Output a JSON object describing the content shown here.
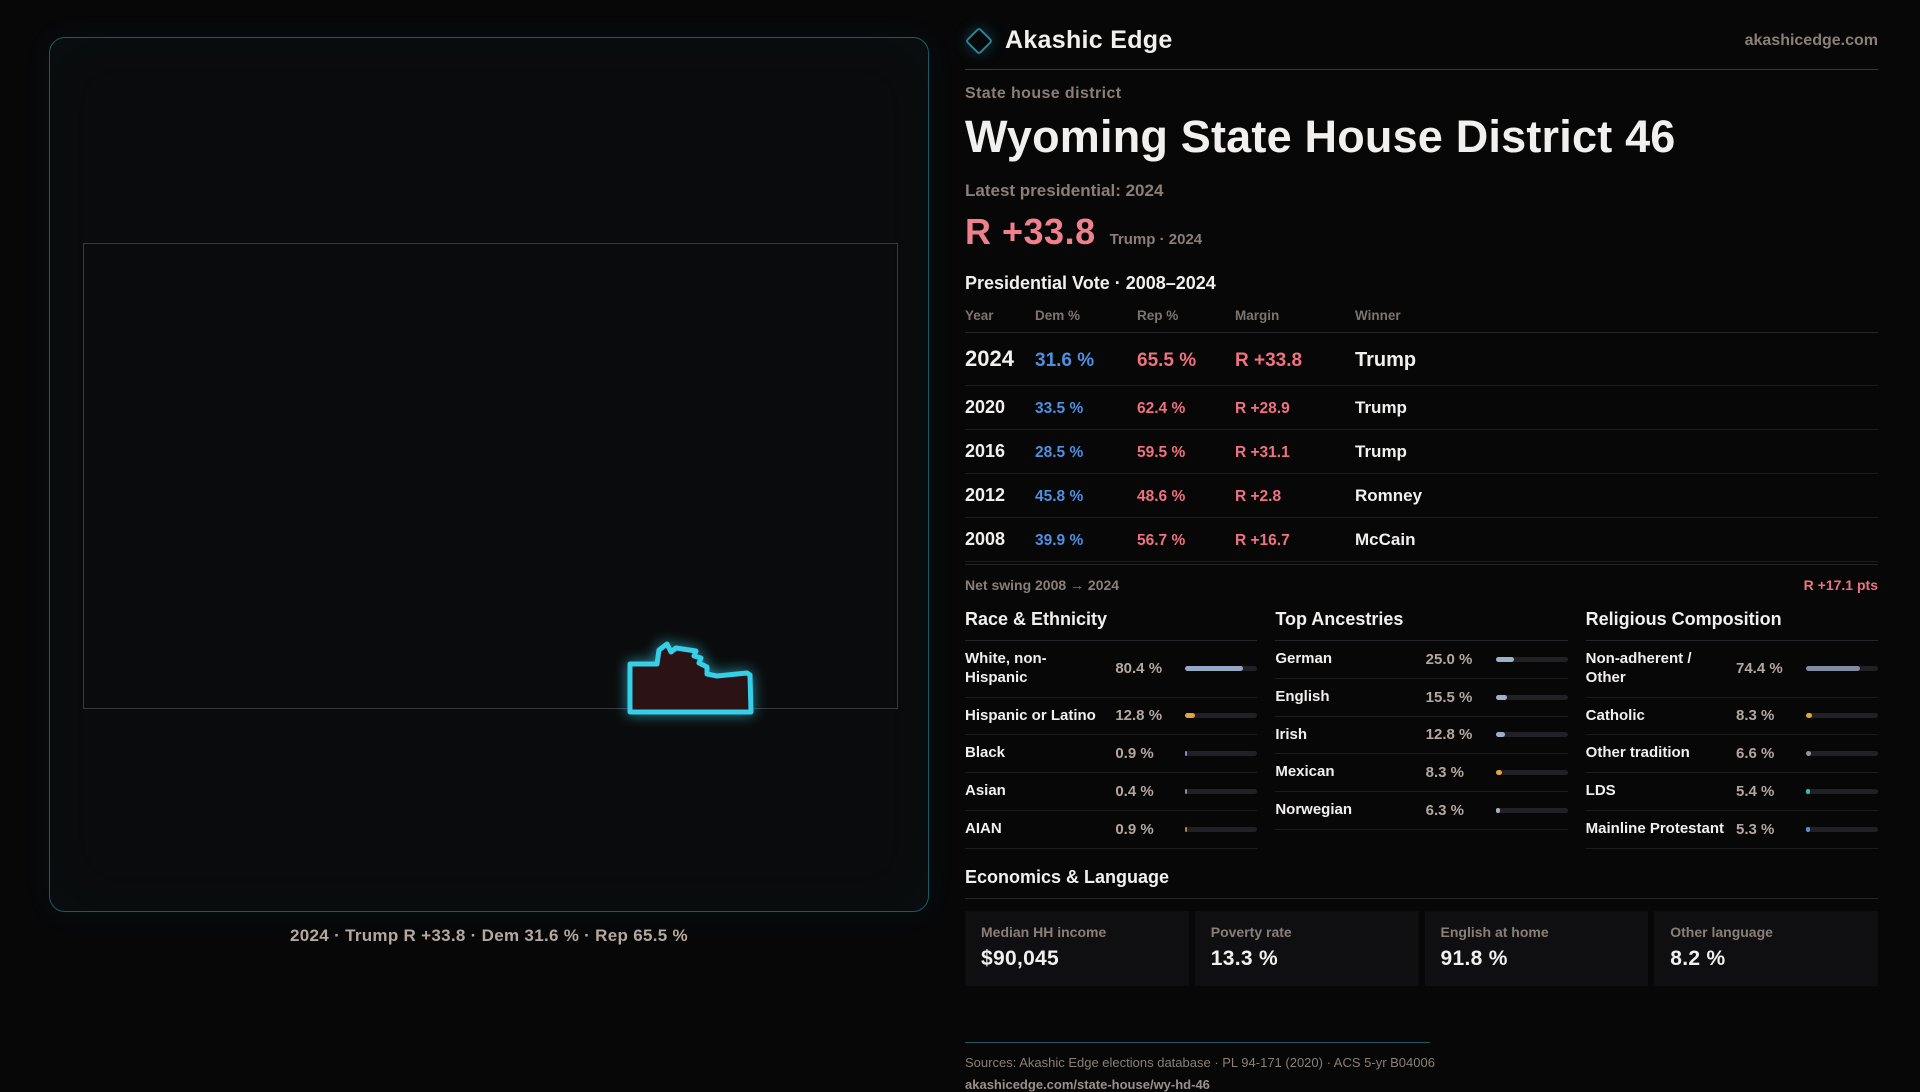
{
  "brand": {
    "name": "Akashic Edge",
    "site": "akashicedge.com"
  },
  "page": {
    "kicker": "State house district",
    "title": "Wyoming State House District 46",
    "latest_label": "Latest presidential: 2024",
    "headline_margin": "R +33.8",
    "headline_context": "Trump · 2024"
  },
  "map": {
    "caption": "2024 · Trump R +33.8 · Dem 31.6 % · Rep 65.5 %",
    "district_outline_color": "#35cfe8",
    "district_fill_color": "#2a1215"
  },
  "vote_table": {
    "title": "Presidential Vote · 2008–2024",
    "columns": [
      "Year",
      "Dem %",
      "Rep %",
      "Margin",
      "Winner"
    ],
    "rows": [
      {
        "year": "2024",
        "dem": "31.6 %",
        "rep": "65.5 %",
        "margin": "R +33.8",
        "winner": "Trump",
        "emphasis": true
      },
      {
        "year": "2020",
        "dem": "33.5 %",
        "rep": "62.4 %",
        "margin": "R +28.9",
        "winner": "Trump",
        "emphasis": false
      },
      {
        "year": "2016",
        "dem": "28.5 %",
        "rep": "59.5 %",
        "margin": "R +31.1",
        "winner": "Trump",
        "emphasis": false
      },
      {
        "year": "2012",
        "dem": "45.8 %",
        "rep": "48.6 %",
        "margin": "R +2.8",
        "winner": "Romney",
        "emphasis": false
      },
      {
        "year": "2008",
        "dem": "39.9 %",
        "rep": "56.7 %",
        "margin": "R +16.7",
        "winner": "McCain",
        "emphasis": false
      }
    ],
    "net_swing_label": "Net swing 2008 → 2024",
    "net_swing_value": "R +17.1 pts"
  },
  "demographics": [
    {
      "title": "Race & Ethnicity",
      "rows": [
        {
          "label": "White, non-Hispanic",
          "value": "80.4 %",
          "pct": 80.4,
          "color": "#93a9c6"
        },
        {
          "label": "Hispanic or Latino",
          "value": "12.8 %",
          "pct": 12.8,
          "color": "#e4a43e"
        },
        {
          "label": "Black",
          "value": "0.9 %",
          "pct": 0.9,
          "color": "#8d82d8"
        },
        {
          "label": "Asian",
          "value": "0.4 %",
          "pct": 0.4,
          "color": "#8a8f98"
        },
        {
          "label": "AIAN",
          "value": "0.9 %",
          "pct": 0.9,
          "color": "#bf7a3c"
        }
      ]
    },
    {
      "title": "Top Ancestries",
      "rows": [
        {
          "label": "German",
          "value": "25.0 %",
          "pct": 25.0,
          "color": "#9db1ca"
        },
        {
          "label": "English",
          "value": "15.5 %",
          "pct": 15.5,
          "color": "#9db1ca"
        },
        {
          "label": "Irish",
          "value": "12.8 %",
          "pct": 12.8,
          "color": "#9db1ca"
        },
        {
          "label": "Mexican",
          "value": "8.3 %",
          "pct": 8.3,
          "color": "#e4a43e"
        },
        {
          "label": "Norwegian",
          "value": "6.3 %",
          "pct": 6.3,
          "color": "#9db1ca"
        }
      ]
    },
    {
      "title": "Religious Composition",
      "rows": [
        {
          "label": "Non-adherent / Other",
          "value": "74.4 %",
          "pct": 74.4,
          "color": "#808ca2"
        },
        {
          "label": "Catholic",
          "value": "8.3 %",
          "pct": 8.3,
          "color": "#e0a832"
        },
        {
          "label": "Other tradition",
          "value": "6.6 %",
          "pct": 6.6,
          "color": "#9096a0"
        },
        {
          "label": "LDS",
          "value": "5.4 %",
          "pct": 5.4,
          "color": "#31c1b0"
        },
        {
          "label": "Mainline Protestant",
          "value": "5.3 %",
          "pct": 5.3,
          "color": "#4f8fe0"
        }
      ]
    }
  ],
  "economics": {
    "title": "Economics & Language",
    "stats": [
      {
        "label": "Median HH income",
        "value": "$90,045"
      },
      {
        "label": "Poverty rate",
        "value": "13.3 %"
      },
      {
        "label": "English at home",
        "value": "91.8 %"
      },
      {
        "label": "Other language",
        "value": "8.2 %"
      }
    ]
  },
  "footer": {
    "sources": "Sources: Akashic Edge elections database · PL 94-171 (2020) · ACS 5-yr B04006",
    "permalink": "akashicedge.com/state-house/wy-hd-46"
  }
}
